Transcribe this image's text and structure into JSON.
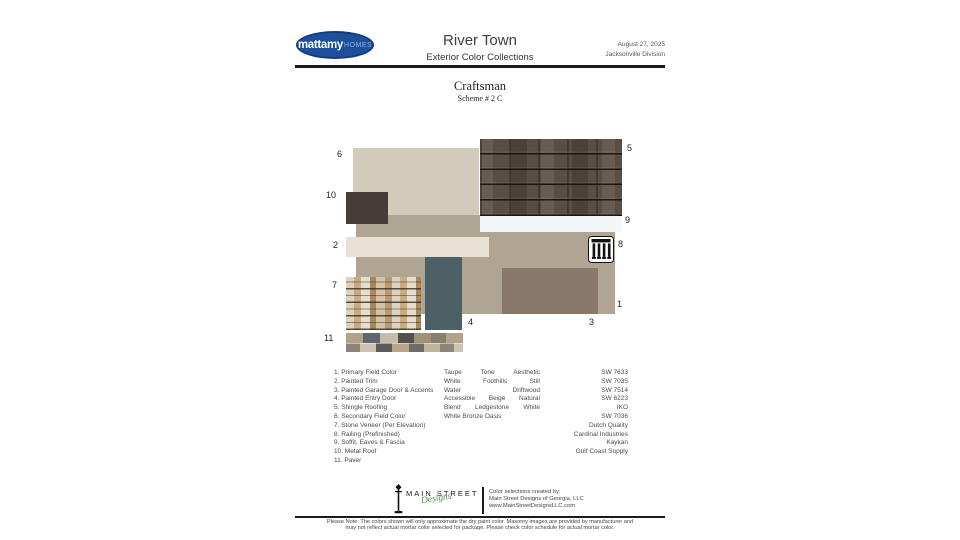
{
  "header": {
    "brand": "mattamy",
    "brand_suffix": "HOMES",
    "title": "River Town",
    "subtitle": "Exterior Color Collections",
    "date": "August 27, 2025",
    "division": "Jacksonville Division"
  },
  "scheme": {
    "style_name": "Craftsman",
    "scheme_number": "Scheme # 2 C"
  },
  "palette": {
    "swatches": [
      {
        "num": "1",
        "label": "Primary Field Color",
        "color": "#b0a493"
      },
      {
        "num": "2",
        "label": "Painted Trim",
        "color": "#e7e2d4"
      },
      {
        "num": "3",
        "label": "Painted Garage Door & Accents",
        "color": "#87786a"
      },
      {
        "num": "4",
        "label": "Painted Entry Door",
        "color": "#4c6066"
      },
      {
        "num": "5",
        "label": "Shingle Roofing",
        "color": "#594e45"
      },
      {
        "num": "6",
        "label": "Secondary Field Color",
        "color": "#d2cabb"
      },
      {
        "num": "7",
        "label": "Stone Veneer",
        "color": "#c9b697"
      },
      {
        "num": "8",
        "label": "Railing",
        "color": "#111111"
      },
      {
        "num": "9",
        "label": "Soffit, Eaves & Fascia",
        "color": "#f3f6f9"
      },
      {
        "num": "10",
        "label": "Metal Roof",
        "color": "#463d38"
      },
      {
        "num": "11",
        "label": "Paver",
        "color": "#97928b"
      }
    ]
  },
  "legend": {
    "items": [
      {
        "label": "1. Primary Field Color",
        "code": "SW 7633"
      },
      {
        "label": "2. Painted Trim",
        "code": "SW 7035"
      },
      {
        "label": "3. Painted Garage Door & Accents",
        "code": "SW 7514"
      },
      {
        "label": "4. Painted Entry Door",
        "code": "SW 6223"
      },
      {
        "label": "5. Shingle Roofing",
        "code": "IKO"
      },
      {
        "label": "6. Secondary Field Color",
        "code": "SW 7036"
      },
      {
        "label": "7. Stone Veneer (Per Elevation)",
        "code": "Dutch Quality"
      },
      {
        "label": "8. Railing (Prefinished)",
        "code": "Cardinal Industries"
      },
      {
        "label": "9. Soffit, Eaves & Fascia",
        "code": "Kaykan"
      },
      {
        "label": "10. Metal Roof",
        "code": "Gulf Coast Supply"
      },
      {
        "label": "11. Paver",
        "code": ""
      }
    ],
    "color_name_lines": [
      "Taupe Tone Aesthetic",
      "White Foothills Still",
      "Water Driftwood",
      "Accessible Beige Natural",
      "Blend Ledgestone White",
      "White Bronze Oasis"
    ]
  },
  "footer": {
    "designer_name": "MAIN STREET",
    "designer_script": "Designs",
    "credit_lines": [
      "Color selections created by:",
      "Main Street Designs of Georgia, LLC",
      "www.MainStreetDesignsLLC.com"
    ],
    "note_lines": [
      "Please Note: The colors shown will only approximate the dry paint color. Masonry images are provided by manufacturer and",
      "may not reflect actual mortar color selected for package. Please check color schedule for actual mortar color."
    ]
  }
}
